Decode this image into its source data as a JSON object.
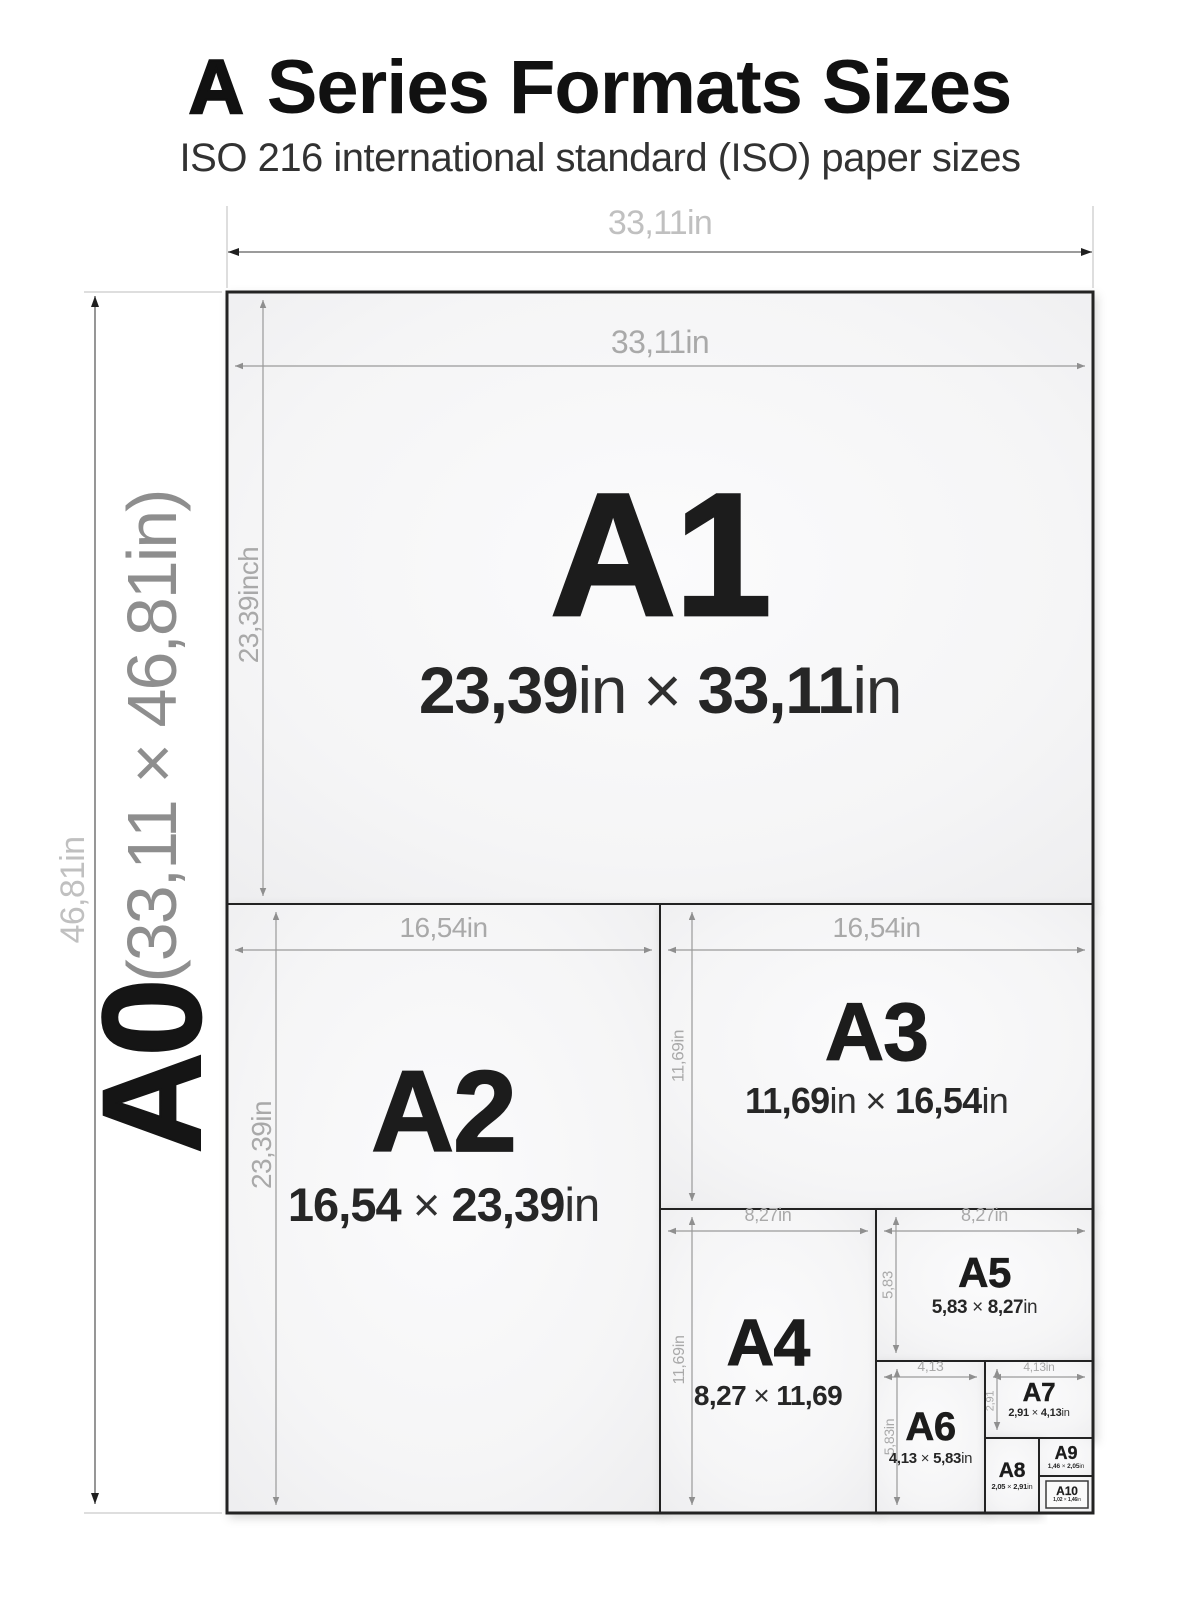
{
  "header": {
    "title_bold": "A",
    "title_rest": " Series Formats Sizes",
    "subtitle": "ISO 216 international standard (ISO) paper sizes"
  },
  "a0": {
    "name": "A0",
    "dims": "(33,11 × 46,81in)",
    "width_label": "33,11in",
    "height_label": "46,81in"
  },
  "formats": [
    {
      "name": "A1",
      "dims": "23,39in × 33,11in",
      "width_label": "33,11in",
      "height_label": "23,39inch"
    },
    {
      "name": "A2",
      "dims": "16,54 × 23,39in",
      "width_label": "16,54in",
      "height_label": "23,39in"
    },
    {
      "name": "A3",
      "dims": "11,69in × 16,54in",
      "width_label": "16,54in",
      "height_label": "11,69in"
    },
    {
      "name": "A4",
      "dims": "8,27 × 11,69",
      "width_label": "8,27in",
      "height_label": "11,69in"
    },
    {
      "name": "A5",
      "dims": "5,83 × 8,27in",
      "width_label": "8,27in",
      "height_label": "5,83"
    },
    {
      "name": "A6",
      "dims": "4,13 × 5,83in",
      "width_label": "4,13",
      "height_label": "5,83in"
    },
    {
      "name": "A7",
      "dims": "2,91 × 4,13in",
      "width_label": "4,13in",
      "height_label": "2,91"
    },
    {
      "name": "A8",
      "dims": "2,05 × 2,91in"
    },
    {
      "name": "A9",
      "dims": "1,46 × 2,05in"
    },
    {
      "name": "A10",
      "dims": "1,02 × 1,46in"
    }
  ],
  "colors": {
    "paper_fill": "#f4f4f5",
    "paper_border": "#232323",
    "dim_line": "#9a9a9a",
    "outer_dim_line": "#5f5f5f",
    "dim_label": "#a9a9a9",
    "outer_dim_label": "#c0c0c0",
    "text": "#1d1d1d",
    "subtitle": "#323232"
  }
}
